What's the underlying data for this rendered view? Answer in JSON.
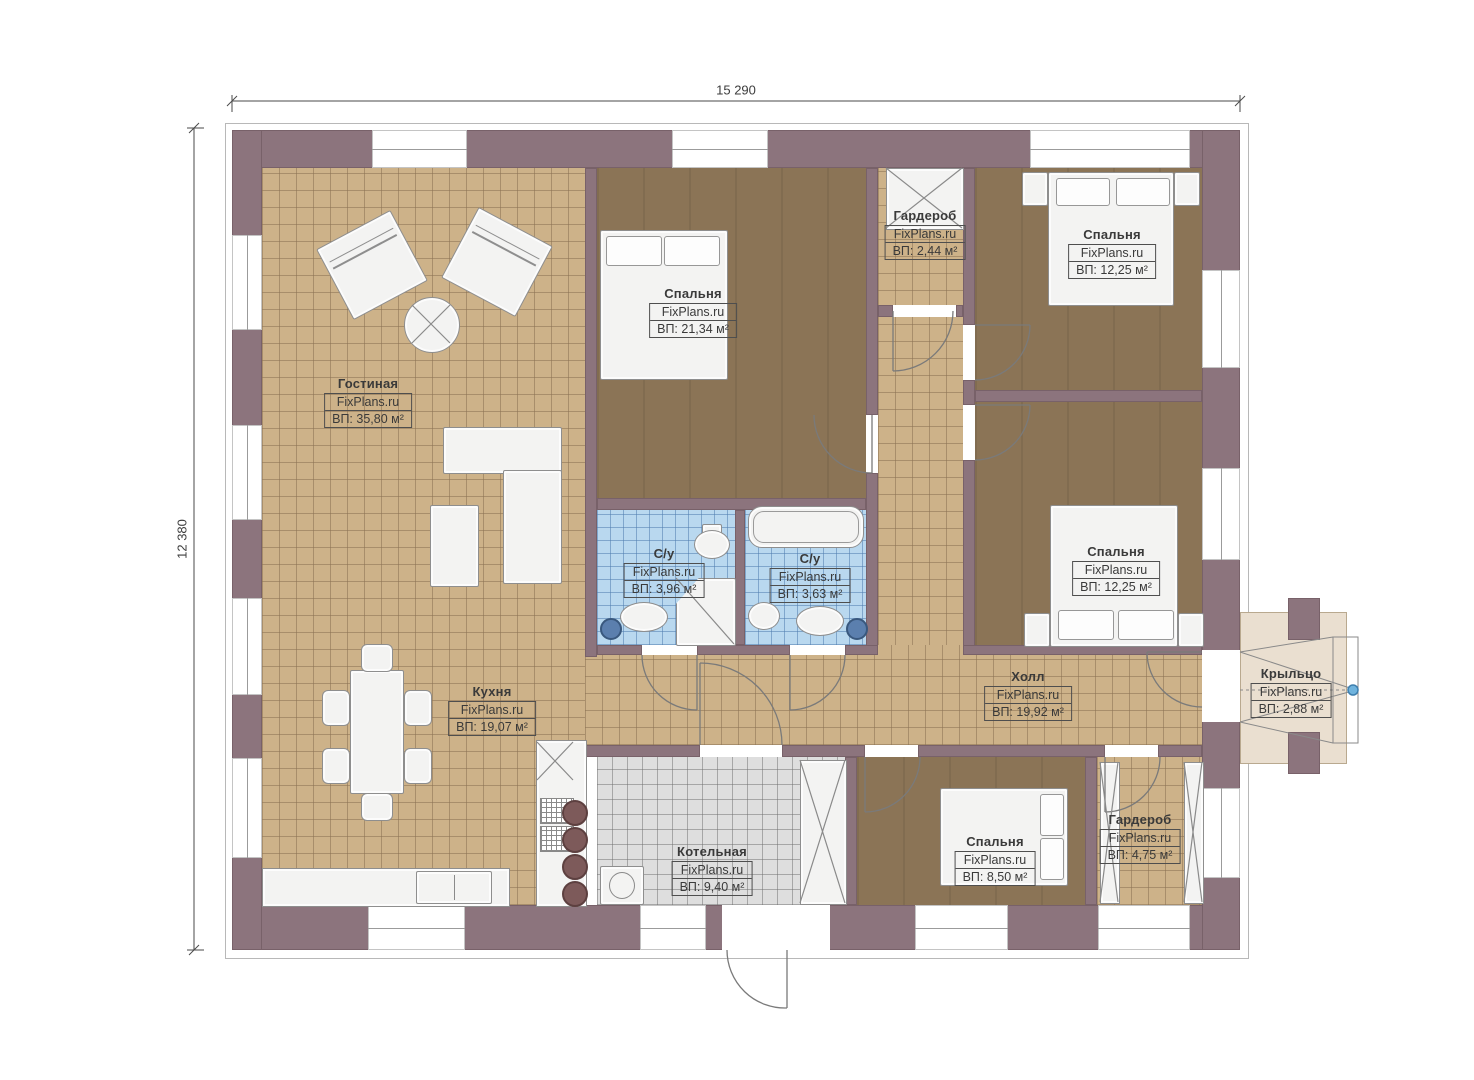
{
  "brand": "FixPlans.ru",
  "dimensions": {
    "width": "15 290",
    "height": "12 380"
  },
  "rooms": [
    {
      "id": "living",
      "name": "Гостиная",
      "area": "ВП: 35,80 м²"
    },
    {
      "id": "bedroom-1",
      "name": "Спальня",
      "area": "ВП: 21,34 м²"
    },
    {
      "id": "wardrobe-1",
      "name": "Гардероб",
      "area": "ВП: 2,44 м²"
    },
    {
      "id": "bedroom-2",
      "name": "Спальня",
      "area": "ВП: 12,25 м²"
    },
    {
      "id": "bedroom-3",
      "name": "Спальня",
      "area": "ВП: 12,25 м²"
    },
    {
      "id": "bath-1",
      "name": "С/у",
      "area": "ВП: 3,96 м²"
    },
    {
      "id": "bath-2",
      "name": "С/у",
      "area": "ВП: 3,63 м²"
    },
    {
      "id": "kitchen",
      "name": "Кухня",
      "area": "ВП: 19,07 м²"
    },
    {
      "id": "hall",
      "name": "Холл",
      "area": "ВП: 19,92 м²"
    },
    {
      "id": "boiler",
      "name": "Котельная",
      "area": "ВП: 9,40 м²"
    },
    {
      "id": "bedroom-4",
      "name": "Спальня",
      "area": "ВП: 8,50 м²"
    },
    {
      "id": "wardrobe-2",
      "name": "Гардероб",
      "area": "ВП: 4,75 м²"
    },
    {
      "id": "porch",
      "name": "Крыльцо",
      "area": "ВП: 2,88 м²"
    }
  ],
  "colors": {
    "wall": "#8c747d",
    "tile_tan": "#cdb289",
    "tile_blue": "#b9d8ef",
    "tile_gray": "#dedede",
    "wood": "#8b7456",
    "porch": "#eadfd0",
    "handle": "#6fb3dd"
  }
}
